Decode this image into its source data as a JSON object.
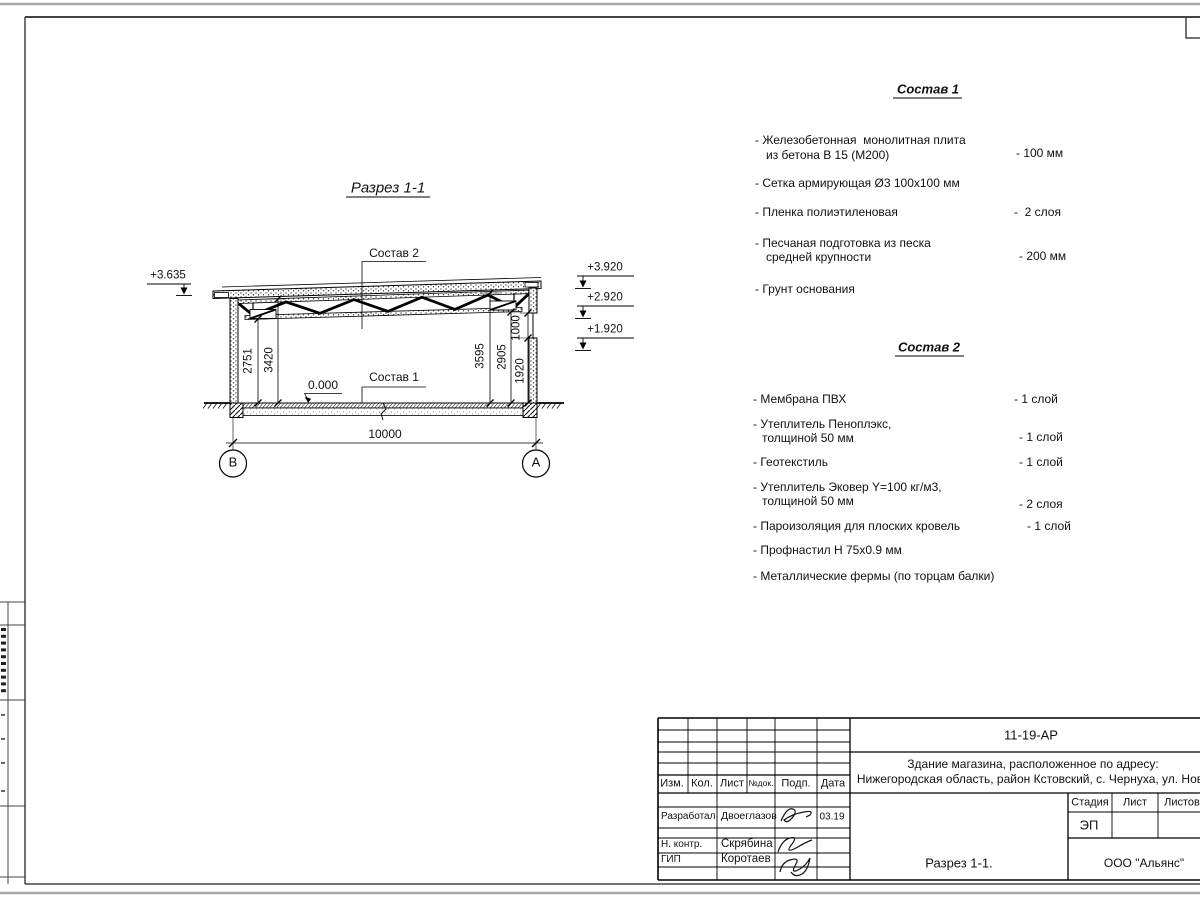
{
  "drawing": {
    "title": "Разрез 1-1",
    "labels": {
      "sostav2_ref": "Состав 2",
      "sostav1_ref": "Состав 1",
      "zero_level": "0.000"
    },
    "elevations": {
      "left": "+3.635",
      "right1": "+3.920",
      "right2": "+2.920",
      "right3": "+1.920"
    },
    "dimensions": {
      "left1": "2751",
      "left2": "3420",
      "right1": "3595",
      "right2": "2905",
      "right3": "1920",
      "right4": "1000",
      "overall": "10000"
    },
    "axes": {
      "left": "В",
      "right": "А"
    }
  },
  "sostav1": {
    "title": "Состав 1",
    "items": [
      {
        "line1": "- Железобетонная  монолитная плита",
        "line2": "из бетона В 15 (М200)",
        "value": "- 100 мм"
      },
      {
        "line1": "- Сетка армирующая Ø3 100x100 мм",
        "line2": "",
        "value": ""
      },
      {
        "line1": "- Пленка полиэтиленовая",
        "line2": "",
        "value": "-  2 слоя"
      },
      {
        "line1": "- Песчаная подготовка из песка",
        "line2": "средней крупности",
        "value": "- 200 мм"
      },
      {
        "line1": "- Грунт основания",
        "line2": "",
        "value": ""
      }
    ]
  },
  "sostav2": {
    "title": "Состав 2",
    "items": [
      {
        "line1": "- Мембрана ПВХ",
        "line2": "",
        "value": "- 1 слой"
      },
      {
        "line1": "- Утеплитель Пеноплэкс,",
        "line2": "толщиной 50 мм",
        "value": "- 1 слой"
      },
      {
        "line1": "- Геотекстиль",
        "line2": "",
        "value": "- 1 слой"
      },
      {
        "line1": "- Утеплитель Эковер Y=100 кг/м3,",
        "line2": "толщиной 50 мм",
        "value": "- 2 слоя"
      },
      {
        "line1": "- Пароизоляция для плоских кровель",
        "line2": "",
        "value": "- 1 слой"
      },
      {
        "line1": "- Профнастил Н 75х0.9 мм",
        "line2": "",
        "value": ""
      },
      {
        "line1": "- Металлические фермы (по торцам балки)",
        "line2": "",
        "value": ""
      }
    ]
  },
  "titleblock": {
    "doc_number": "11-19-АР",
    "project_line1": "Здание магазина, расположенное по адресу:",
    "project_line2": "Нижегородская область, район Кстовский, с. Чернуха, ул. Нов",
    "sheet_title": "Разрез 1-1.",
    "company": "ООО \"Альянс\"",
    "stage_value": "ЭП",
    "cols": {
      "izm": "Изм.",
      "kol": "Кол.",
      "list": "Лист",
      "ndok": "№док.",
      "podp": "Подп.",
      "data": "Дата"
    },
    "stage_cols": {
      "stadia": "Стадия",
      "list": "Лист",
      "listov": "Листов"
    },
    "rows": [
      {
        "role": "Разработал",
        "name": "Двоеглазов",
        "date": "03.19"
      },
      {
        "role": "Н. контр.",
        "name": "Скрябина",
        "date": ""
      },
      {
        "role": "ГИП",
        "name": "Коротаев",
        "date": ""
      }
    ]
  }
}
